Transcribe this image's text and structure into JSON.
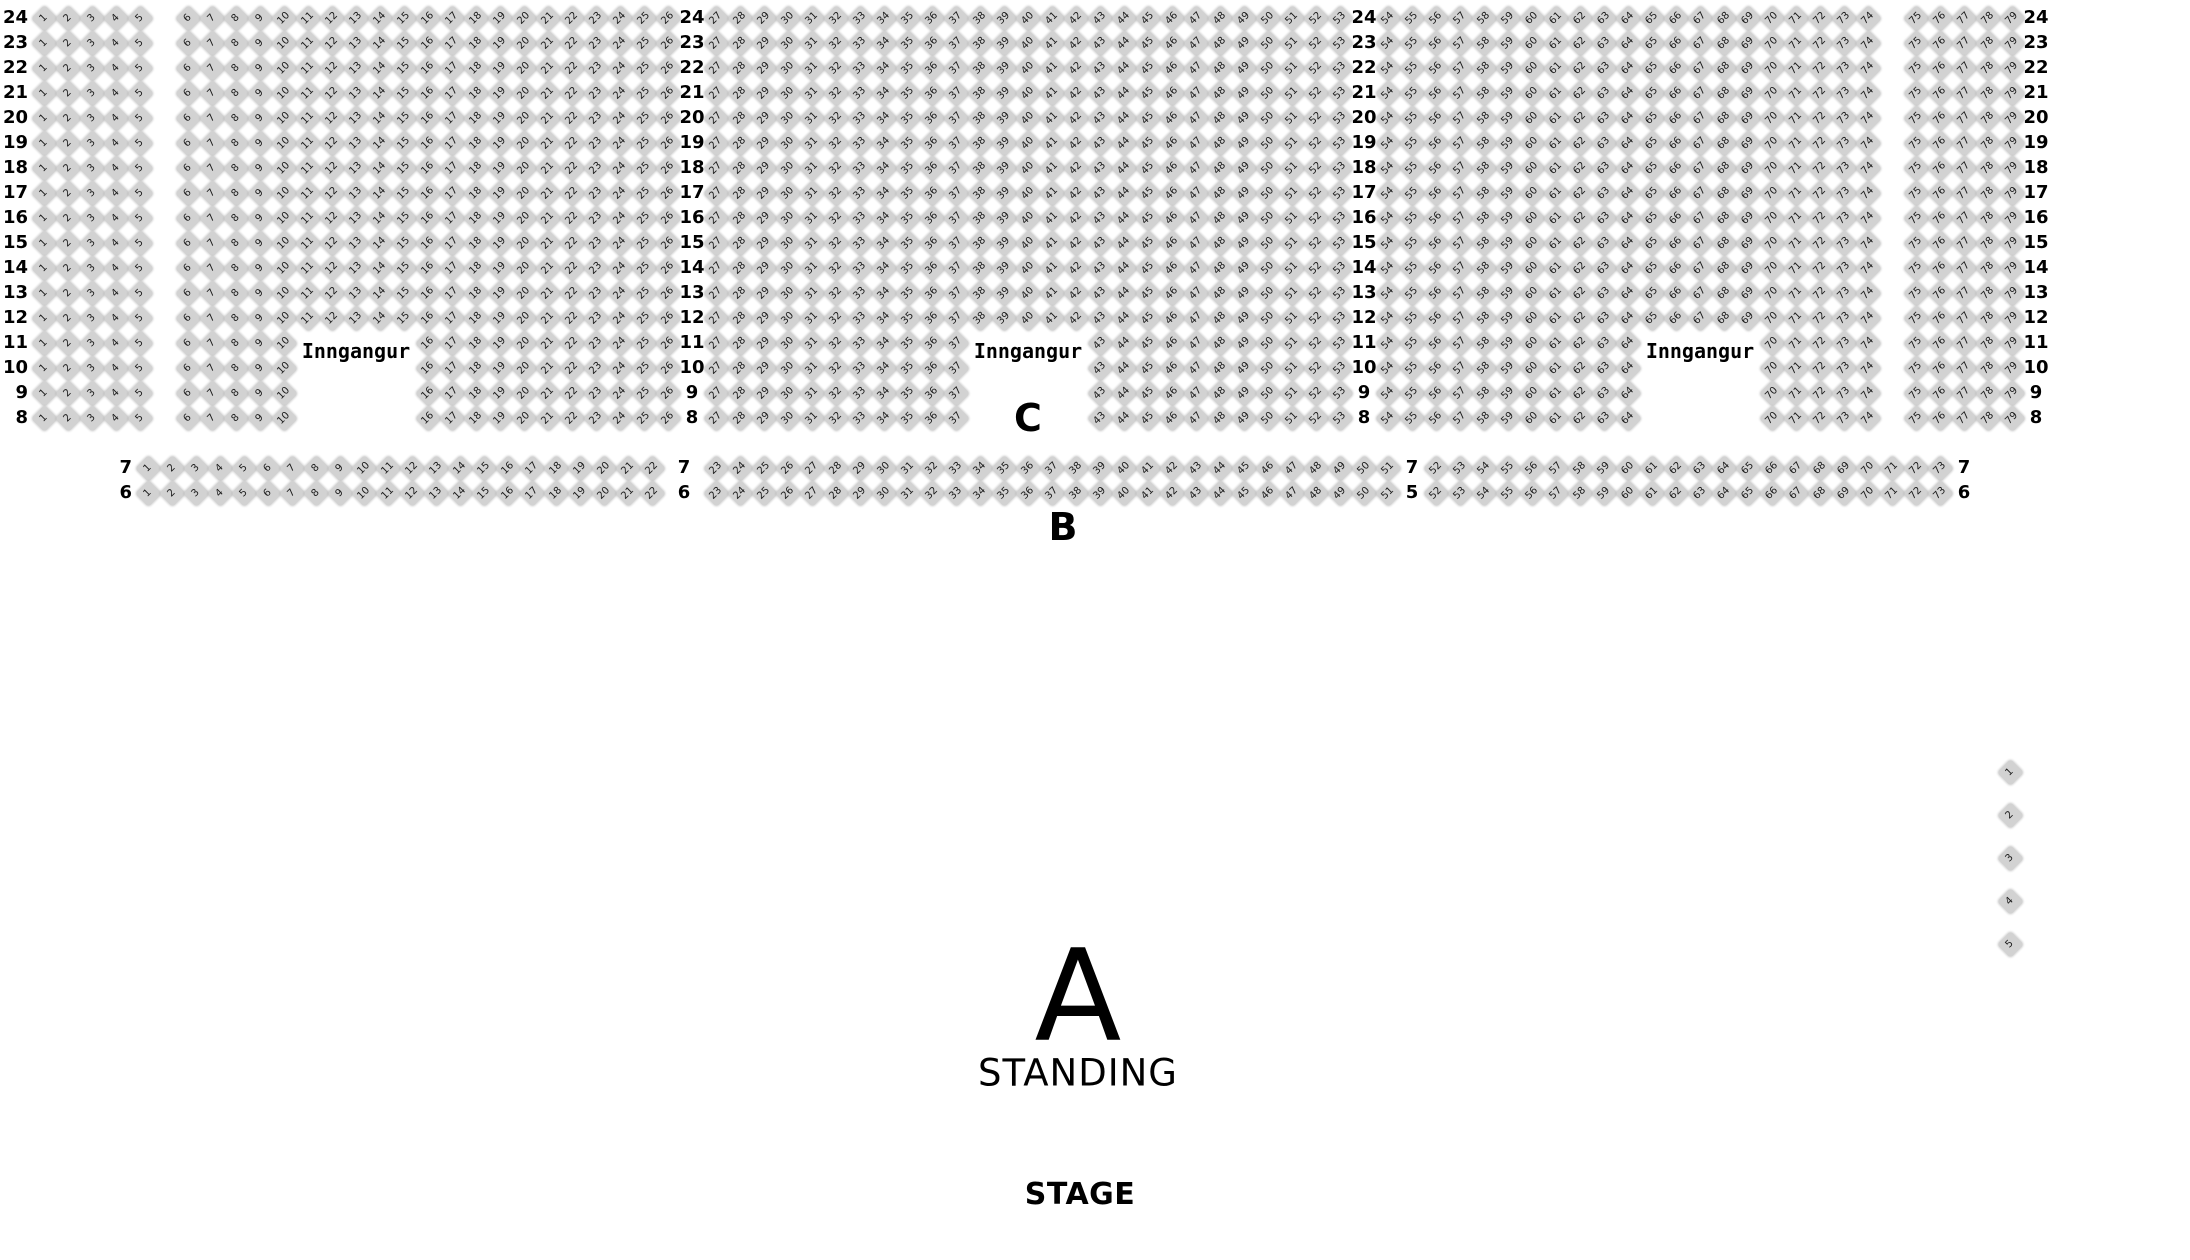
{
  "colors": {
    "background": "#ffffff",
    "seat_fill": "#d2d2d2",
    "seat_number": "#1a1a1a",
    "label_text": "#000000"
  },
  "labels": {
    "entrance": "Inngangur",
    "section_c": "C",
    "section_b": "B",
    "section_a": "A",
    "standing": "STANDING",
    "stage": "STAGE"
  },
  "upper_section": {
    "row_numbers": [
      24,
      23,
      22,
      21,
      20,
      19,
      18,
      17,
      16,
      15,
      14,
      13,
      12,
      11,
      10,
      9,
      8
    ],
    "gapped_rows": [
      11,
      10,
      9,
      8
    ],
    "blocks": [
      {
        "seats_from": 1,
        "seats_to": 5
      },
      {
        "seats_from": 6,
        "seats_to": 26,
        "gap_from": 11,
        "gap_to": 15
      },
      {
        "seats_from": 27,
        "seats_to": 53,
        "gap_from": 38,
        "gap_to": 42
      },
      {
        "seats_from": 54,
        "seats_to": 74,
        "gap_from": 65,
        "gap_to": 69
      },
      {
        "seats_from": 75,
        "seats_to": 79
      }
    ]
  },
  "b_section": {
    "rows": [
      {
        "number": 7,
        "seats_from": 1,
        "seats_to": 73,
        "boundary_labels": [
          "7",
          "7",
          "7",
          "7"
        ]
      },
      {
        "number": 6,
        "seats_from": 1,
        "seats_to": 73,
        "boundary_labels": [
          "6",
          "6",
          "5",
          "6"
        ]
      }
    ],
    "segments": [
      {
        "from": 1,
        "to": 22
      },
      {
        "from": 23,
        "to": 51
      },
      {
        "from": 52,
        "to": 73
      }
    ]
  },
  "side_seats": {
    "numbers": [
      1,
      2,
      3,
      4,
      5
    ]
  }
}
